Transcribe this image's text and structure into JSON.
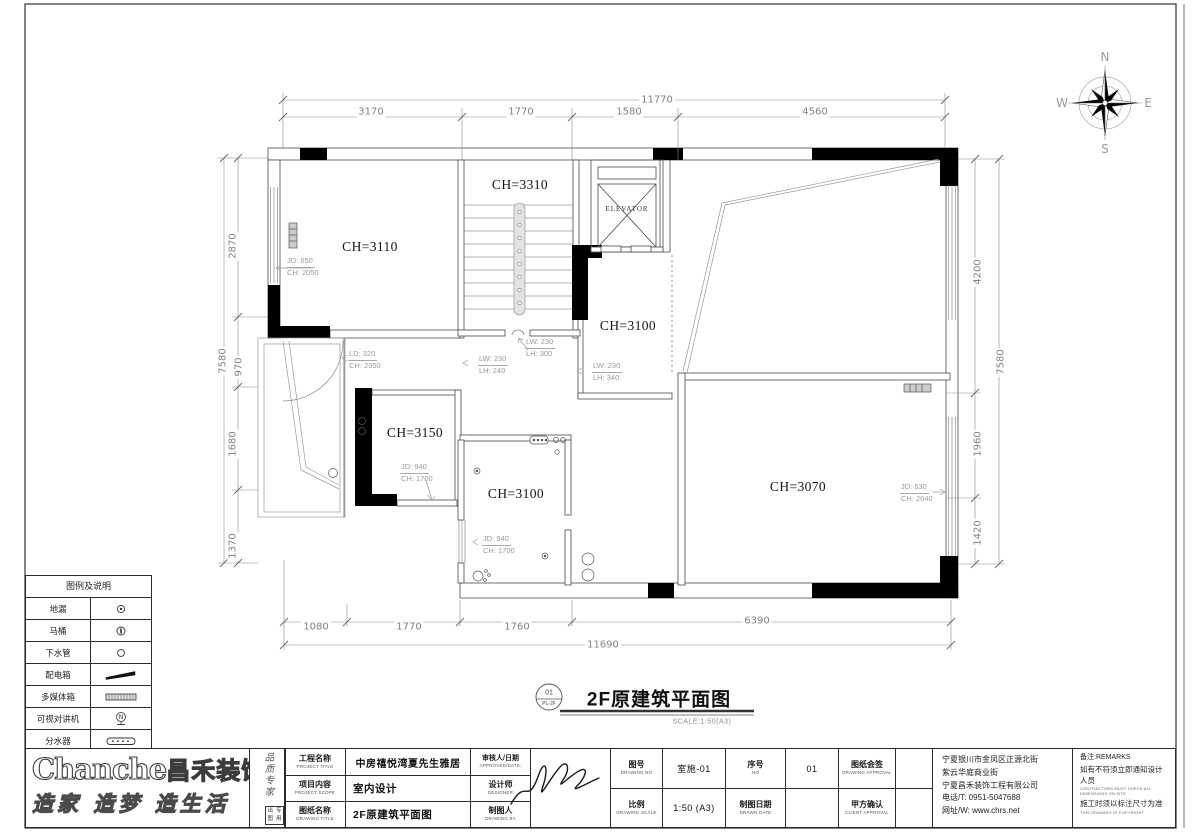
{
  "sheet": {
    "drawing_title": "2F原建筑平面图",
    "scale_note": "SCALE:1:50(A3)",
    "detail_no": "01",
    "detail_ref": "PL-2F"
  },
  "compass": {
    "north": "N",
    "south": "S",
    "east": "E",
    "west": "W"
  },
  "plan": {
    "rooms": [
      {
        "label": "CH=3110"
      },
      {
        "label": "CH=3310"
      },
      {
        "label": "ELEVATOR"
      },
      {
        "label": "CH=3100"
      },
      {
        "label": "CH=3150"
      },
      {
        "label": "CH=3100"
      },
      {
        "label": "CH=3070"
      }
    ],
    "annotations": [
      {
        "line1": "JD: 650",
        "line2": "CH: 2050"
      },
      {
        "line1": "LD: 320",
        "line2": "CH: 2350"
      },
      {
        "line1": "LW: 230",
        "line2": "LH: 300"
      },
      {
        "line1": "LW: 230",
        "line2": "LH: 240"
      },
      {
        "line1": "LW: 230",
        "line2": "LH: 340"
      },
      {
        "line1": "JD: 940",
        "line2": "CH: 1700"
      },
      {
        "line1": "JD: 940",
        "line2": "CH: 1700"
      },
      {
        "line1": "JD: 630",
        "line2": "CH: 2040"
      }
    ],
    "dimensions": {
      "top": {
        "overall": "11770",
        "segments": [
          "3170",
          "1770",
          "1580",
          "4560"
        ]
      },
      "bottom": {
        "overall": "11690",
        "segments": [
          "1080",
          "1770",
          "1760",
          "6390"
        ]
      },
      "left": {
        "overall": "7580",
        "segments": [
          "2870",
          "970",
          "1680",
          "1370"
        ]
      },
      "right": {
        "overall": "7580",
        "segments": [
          "4200",
          "1960",
          "1420"
        ]
      }
    }
  },
  "legend": {
    "title": "图例及说明",
    "items": [
      {
        "label": "地漏"
      },
      {
        "label": "马桶"
      },
      {
        "label": "下水管"
      },
      {
        "label": "配电箱"
      },
      {
        "label": "多媒体箱"
      },
      {
        "label": "可视对讲机"
      },
      {
        "label": "分水器"
      }
    ]
  },
  "titleblock": {
    "brand": {
      "logo_en": "Chanche",
      "logo_cn": "昌禾装饰",
      "slogan": "造家 造梦 造生活",
      "vertical_motto": "品质专家",
      "stamp_row1": "出图",
      "stamp_row2": "专用"
    },
    "fields": [
      {
        "label": "工程名称",
        "en": "PROJECT TITLE",
        "value": "中房禧悦湾夏先生雅居"
      },
      {
        "label": "项目内容",
        "en": "PROJECT SCOPE",
        "value": "室内设计"
      },
      {
        "label": "图纸名称",
        "en": "DRAWING TITLE",
        "value": "2F原建筑平面图"
      },
      {
        "label": "审核人/日期",
        "en": "APPROVED/DATE:",
        "value": ""
      },
      {
        "label": "设计师",
        "en": "DESIGNER",
        "value": ""
      },
      {
        "label": "制图人",
        "en": "DRAWING BY",
        "value": ""
      },
      {
        "label": "图号",
        "en": "DRAWING NO",
        "value": "室施-01"
      },
      {
        "label": "序号",
        "en": "NO",
        "value": "01"
      },
      {
        "label": "比例",
        "en": "DRAWING SCALE",
        "value": "1:50 (A3)"
      },
      {
        "label": "制图日期",
        "en": "DRAWN DATE",
        "value": ""
      },
      {
        "label": "图纸会签",
        "en": "DRAWING APPROVAL",
        "value": ""
      },
      {
        "label": "甲方确认",
        "en": "CLIENT APPROVAL",
        "value": ""
      }
    ],
    "company": {
      "address1": "宁夏银川市金凤区正源北街",
      "address2": "紫云华庭商业街",
      "name": "宁夏昌禾装饰工程有限公司",
      "phone": "电话/T: 0951-5047688",
      "web": "网址/W: www.chrs.net"
    },
    "remarks": {
      "title": "备注:REMARKS",
      "line1": "如有不符须立即通知设计人员",
      "line1_en": "CONTRACTORS MUST CHECK ALL DIMENSIONS ON SITE",
      "line2": "施工时须以标注尺寸为准",
      "line2_en": "THIS DRAWING IS COPYRIGHT"
    }
  }
}
